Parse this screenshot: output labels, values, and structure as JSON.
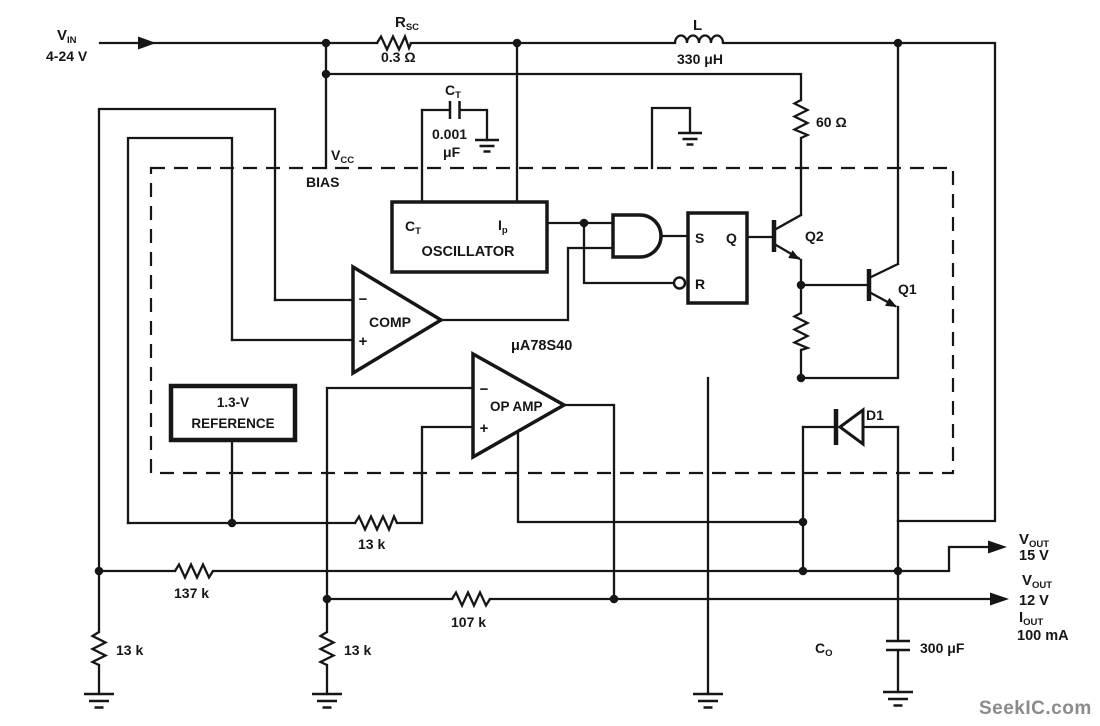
{
  "input": {
    "v_label": "V",
    "v_sub": "IN",
    "range": "4-24 V"
  },
  "ic": {
    "name": "μA78S40",
    "vcc_label": "V",
    "vcc_sub": "CC",
    "bias": "BIAS"
  },
  "components": {
    "rsc": {
      "label": "R",
      "sub": "SC",
      "value": "0.3 Ω"
    },
    "inductor": {
      "label": "L",
      "value": "330 μH"
    },
    "ct_cap": {
      "label": "C",
      "sub": "T",
      "value_num": "0.001",
      "value_unit": "μF"
    },
    "r60": {
      "value": "60 Ω"
    },
    "oscillator": {
      "pin_ct": "C",
      "pin_ct_sub": "T",
      "pin_ip": "I",
      "pin_ip_sub": "p",
      "title": "OSCILLATOR"
    },
    "flipflop": {
      "s": "S",
      "q": "Q",
      "r": "R"
    },
    "q2": {
      "label": "Q2"
    },
    "q1": {
      "label": "Q1"
    },
    "comparator": {
      "label": "COMP",
      "minus": "−",
      "plus": "+"
    },
    "opamp": {
      "label": "OP AMP",
      "minus": "−",
      "plus": "+"
    },
    "reference": {
      "line1": "1.3-V",
      "line2": "REFERENCE"
    },
    "d1": {
      "label": "D1"
    },
    "r13k_ref": "13 k",
    "r137k": "137 k",
    "r13k_left": "13 k",
    "r13k_mid": "13 k",
    "r107k": "107 k",
    "co": {
      "label": "C",
      "sub": "O",
      "value": "300 μF"
    }
  },
  "outputs": {
    "vout15": {
      "label": "V",
      "sub": "OUT",
      "value": "15 V"
    },
    "vout12": {
      "label": "V",
      "sub": "OUT",
      "value": "12 V"
    },
    "iout": {
      "label": "I",
      "sub": "OUT",
      "value": "100 mA"
    }
  },
  "watermark": "SeekIC.com"
}
